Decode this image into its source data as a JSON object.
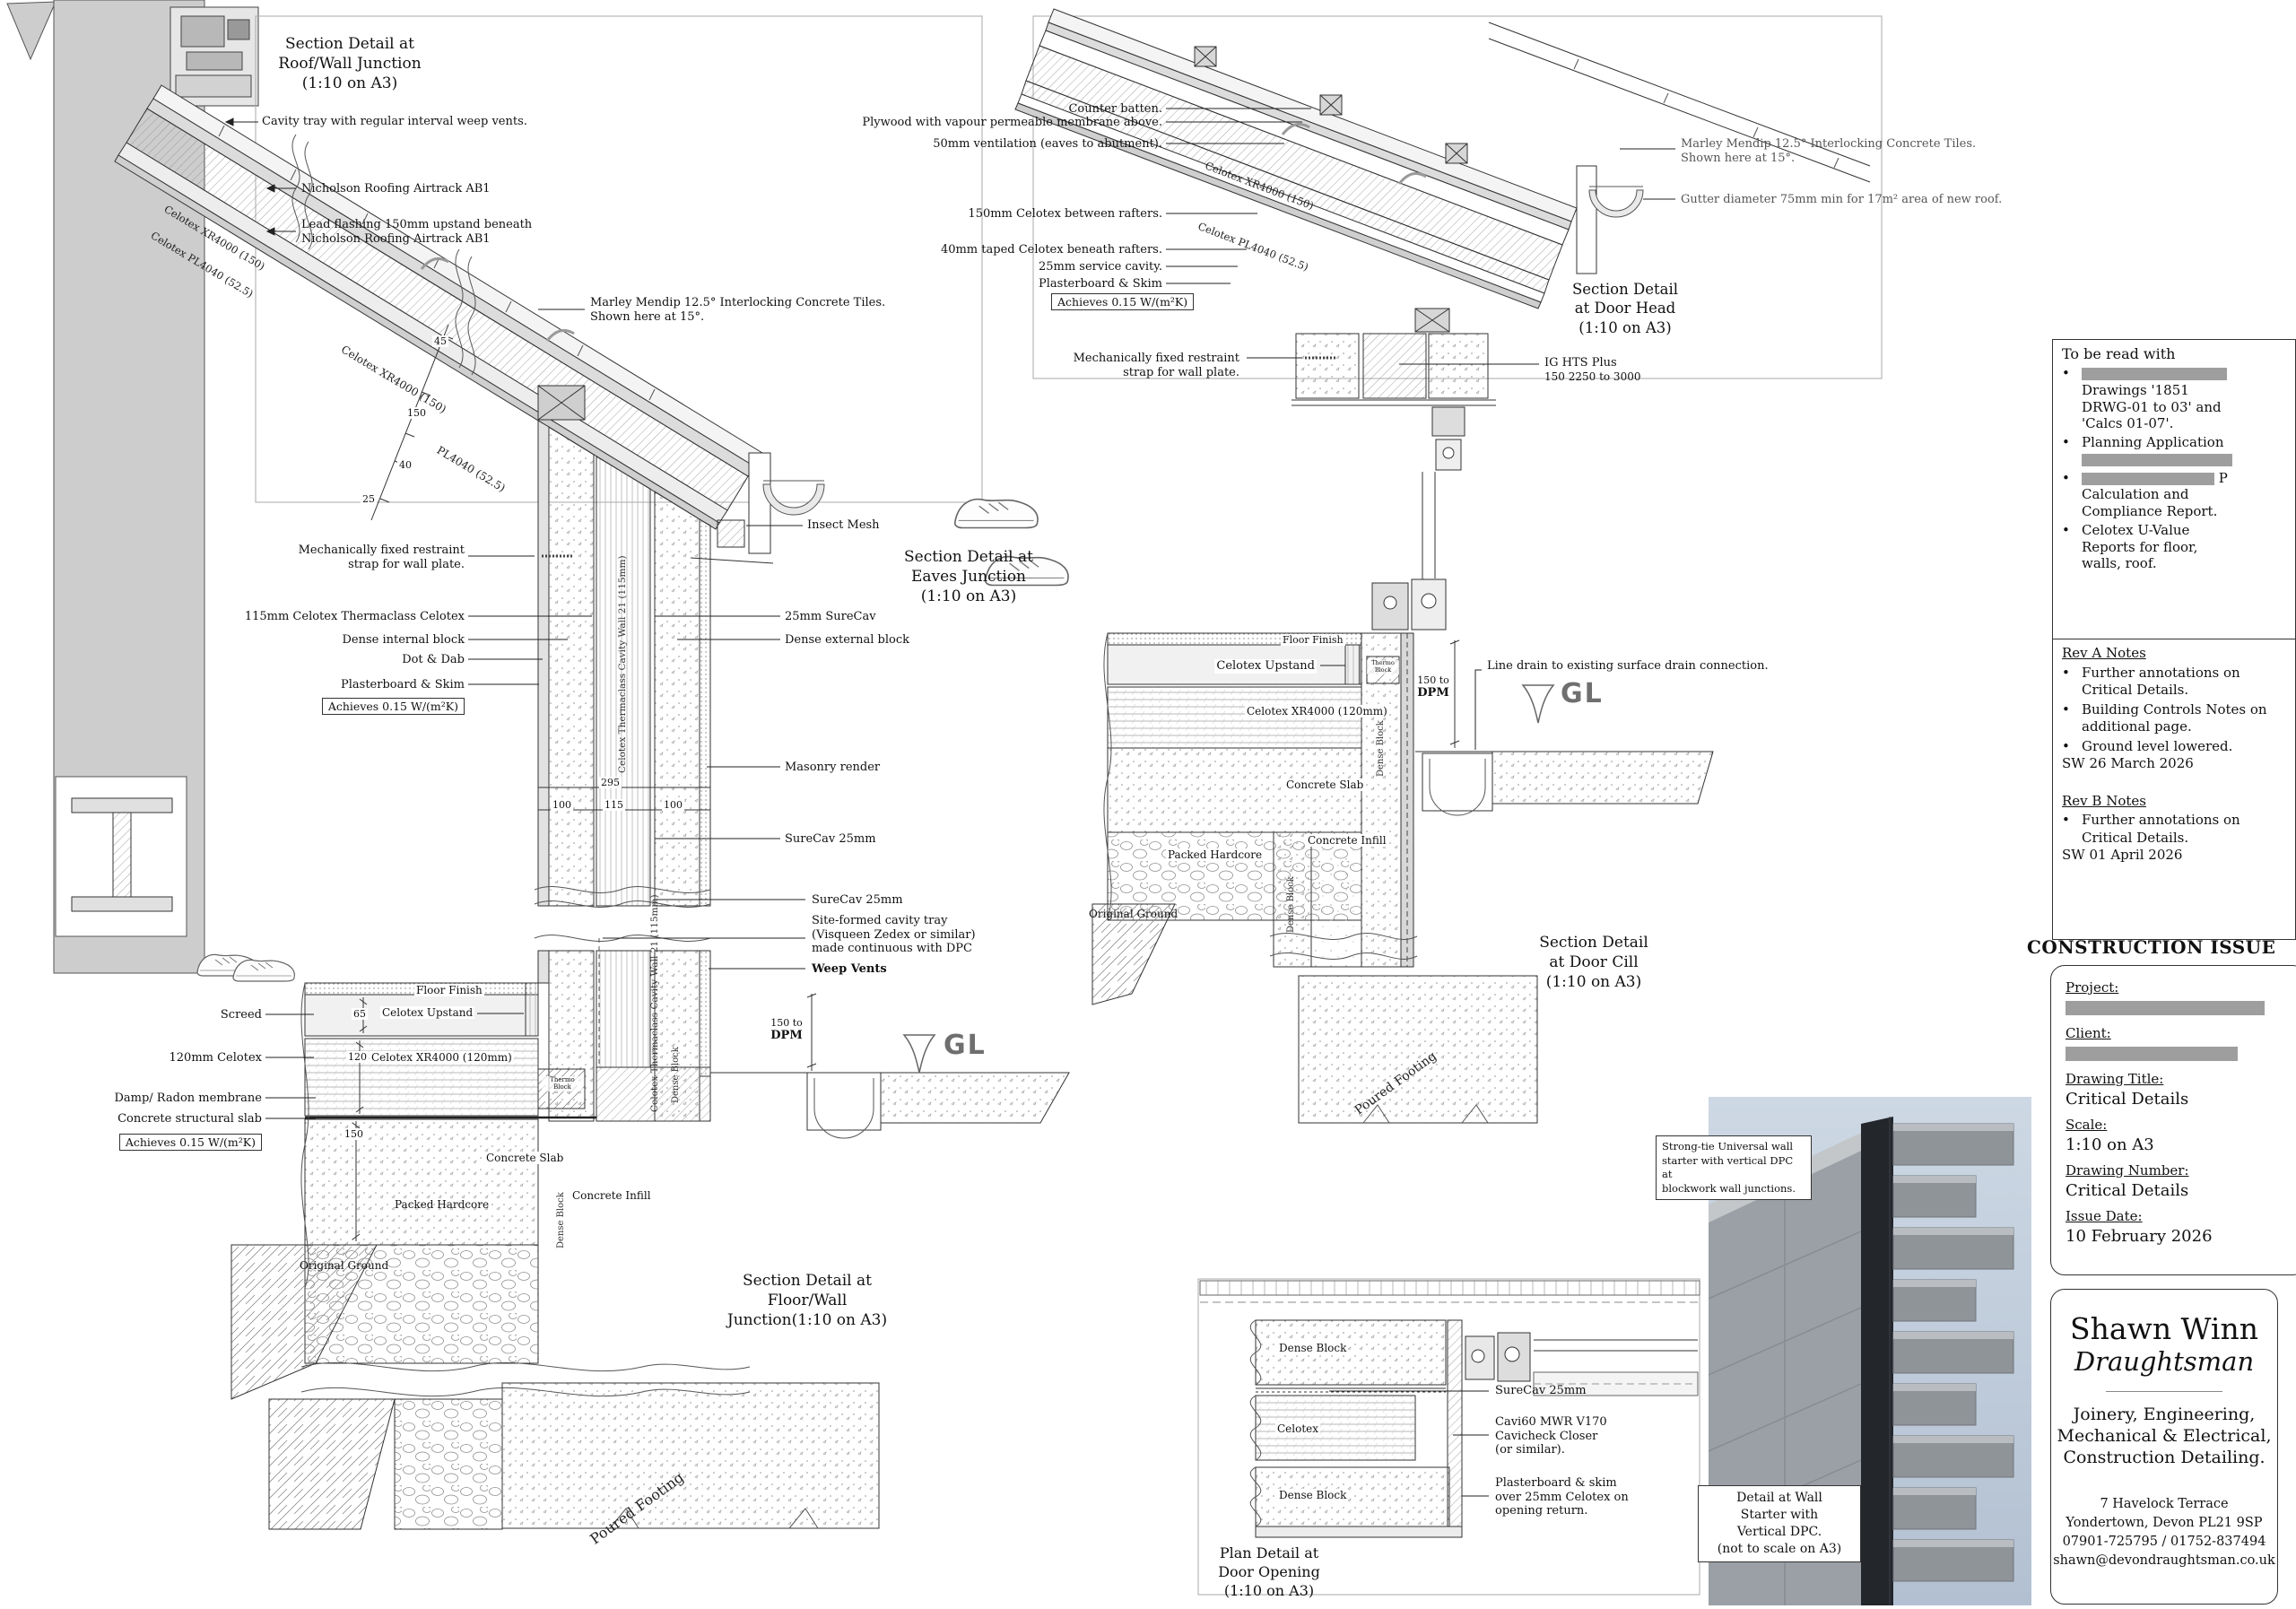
{
  "roof_wall": {
    "title_l1": "Section Detail at",
    "title_l2": "Roof/Wall Junction",
    "title_l3": "(1:10 on A3)",
    "cavity_tray": "Cavity tray with regular interval weep vents.",
    "airtrack": "Nicholson Roofing Airtrack AB1",
    "lead_flashing_l1": "Lead flashing 150mm upstand beneath",
    "lead_flashing_l2": "Nicholson Roofing Airtrack AB1",
    "celotex_xr": "Celotex XR4000 (150)",
    "celotex_pl": "Celotex PL4040 (52.5)"
  },
  "eaves": {
    "title_l1": "Section Detail at",
    "title_l2": "Eaves Junction",
    "title_l3": "(1:10 on A3)",
    "marley_l1": "Marley Mendip 12.5° Interlocking Concrete Tiles.",
    "marley_l2": "Shown here at 15°.",
    "dim_45": "45",
    "dim_150": "150",
    "dim_40": "40",
    "dim_25": "25",
    "dim_total": "295",
    "dim_100a": "100",
    "dim_115": "115",
    "dim_100b": "100",
    "celotex_xr": "Celotex XR4000 (150)",
    "pl4040": "PL4040 (52.5)",
    "restraint_l1": "Mechanically fixed restraint",
    "restraint_l2": "strap for wall plate.",
    "thermaclass": "115mm Celotex Thermaclass Celotex",
    "dense_internal": "Dense internal block",
    "dot_dab": "Dot & Dab",
    "plasterboard": "Plasterboard & Skim",
    "achieves": "Achieves 0.15 W/(m²K)",
    "surecav_right": "25mm SureCav",
    "dense_external": "Dense external block",
    "masonry_render": "Masonry render",
    "surecav_lower": "SureCav 25mm",
    "insect_mesh": "Insect Mesh",
    "cavity_wall_vertical": "Celotex Thermaclass Cavity Wall 21 (115mm)"
  },
  "floor_wall": {
    "title_l1": "Section Detail at",
    "title_l2": "Floor/Wall",
    "title_l3": "Junction(1:10 on A3)",
    "screed": "Screed",
    "celotex_120": "120mm Celotex",
    "damp": "Damp/ Radon membrane",
    "slab": "Concrete structural slab",
    "achieves": "Achieves 0.15 W/(m²K)",
    "floor_finish": "Floor Finish",
    "dim_65": "65",
    "celotex_upstand": "Celotex Upstand",
    "dim_120": "120",
    "xr4000_120": "Celotex XR4000 (120mm)",
    "dim_150": "150",
    "concrete_slab": "Concrete Slab",
    "packed_hardcore": "Packed Hardcore",
    "dense_block": "Dense Block",
    "concrete_infill": "Concrete Infill",
    "original_ground": "Original Ground",
    "poured_footing": "Poured Footing",
    "thermo_l1": "Thermo",
    "thermo_l2": "Block",
    "surecav": "SureCav 25mm",
    "cavity_tray_l1": "Site-formed cavity tray",
    "cavity_tray_l2": "(Visqueen Zedex or similar)",
    "cavity_tray_l3": "made continuous with DPC",
    "weep_vents": "Weep Vents",
    "dpm_l1": "150 to",
    "dpm_l2": "DPM",
    "gl": "GL",
    "cavity_wall_vertical": "Celotex Thermaclass Cavity Wall 21 (115mm)"
  },
  "door_head": {
    "title_l1": "Section Detail",
    "title_l2": "at Door Head",
    "title_l3": "(1:10 on A3)",
    "counter_batten": "Counter batten.",
    "plywood": "Plywood with vapour permeable membrane above.",
    "ventilation": "50mm ventilation (eaves to abutment).",
    "celotex_150": "150mm Celotex between rafters.",
    "celotex_40": "40mm taped Celotex beneath rafters.",
    "service_cavity": "25mm service cavity.",
    "plasterboard": "Plasterboard & Skim",
    "achieves": "Achieves 0.15 W/(m²K)",
    "restraint_l1": "Mechanically fixed restraint",
    "restraint_l2": "strap for wall plate.",
    "ig_l1": "IG HTS Plus",
    "ig_l2": "150 2250 to 3000",
    "marley_l1": "Marley Mendip 12.5° Interlocking Concrete Tiles.",
    "marley_l2": "Shown here at 15°.",
    "gutter": "Gutter diameter 75mm min for 17m² area of new roof.",
    "celotex_xr": "Celotex XR4000 (150)",
    "celotex_pl": "Celotex PL4040 (52.5)"
  },
  "door_cill": {
    "title_l1": "Section Detail",
    "title_l2": "at Door Cill",
    "title_l3": "(1:10 on A3)",
    "floor_finish": "Floor Finish",
    "celotex_upstand": "Celotex Upstand",
    "xr4000_120": "Celotex XR4000 (120mm)",
    "concrete_slab": "Concrete Slab",
    "packed_hardcore": "Packed Hardcore",
    "original_ground": "Original Ground",
    "dense_block_a": "Dense Block",
    "dense_block_b": "Dense Block",
    "concrete_infill": "Concrete Infill",
    "thermo_l1": "Thermo",
    "thermo_l2": "Block",
    "dpm_l1": "150 to",
    "dpm_l2": "DPM",
    "gl": "GL",
    "line_drain": "Line drain to existing surface drain connection.",
    "poured_footing": "Poured Footing"
  },
  "plan_door": {
    "title_l1": "Plan Detail at",
    "title_l2": "Door Opening",
    "title_l3": "(1:10 on A3)",
    "dense_block_a": "Dense Block",
    "celotex": "Celotex",
    "dense_block_b": "Dense Block",
    "surecav": "SureCav 25mm",
    "cavicheck_l1": "Cavi60 MWR V170",
    "cavicheck_l2": "Cavicheck Closer",
    "cavicheck_l3": "(or similar).",
    "plaster_l1": "Plasterboard & skim",
    "plaster_l2": "over 25mm Celotex on",
    "plaster_l3": "opening return."
  },
  "wall_starter": {
    "label_l1": "Strong-tie Universal wall",
    "label_l2": "starter with vertical DPC at",
    "label_l3": "blockwork wall junctions.",
    "caption_l1": "Detail at Wall",
    "caption_l2": "Starter with",
    "caption_l3": "Vertical DPC.",
    "caption_l4": "(not to scale on A3)"
  },
  "read_with": {
    "title": "To be read with",
    "bullet": "•",
    "item1_l1": "Drawings '1851",
    "item1_l2": "DRWG-01 to 03' and",
    "item1_l3": "'Calcs 01-07'.",
    "item2": "Planning Application",
    "item3_suffix": "P",
    "item3_l2": "Calculation and",
    "item3_l3": "Compliance Report.",
    "item4_l1": "Celotex U-Value",
    "item4_l2": "Reports for floor,",
    "item4_l3": "walls, roof."
  },
  "revisions": {
    "bullet": "•",
    "rev_a_title": "Rev A Notes",
    "rev_a_1": "Further annotations on Critical Details.",
    "rev_a_2": "Building Controls Notes on additional page.",
    "rev_a_3": "Ground level lowered.",
    "rev_a_sign": "SW 26 March 2026",
    "rev_b_title": "Rev B Notes",
    "rev_b_1": "Further annotations on Critical Details.",
    "rev_b_sign": "SW 01 April 2026"
  },
  "issue": {
    "heading": "CONSTRUCTION ISSUE",
    "project_label": "Project:",
    "client_label": "Client:",
    "drawing_title_label": "Drawing Title:",
    "drawing_title": "Critical Details",
    "scale_label": "Scale:",
    "scale": "1:10 on A3",
    "drawing_number_label": "Drawing Number:",
    "drawing_number": "Critical Details",
    "issue_date_label": "Issue Date:",
    "issue_date": "10 February 2026"
  },
  "brand": {
    "name": "Shawn Winn",
    "role": "Draughtsman",
    "services_l1": "Joinery, Engineering,",
    "services_l2": "Mechanical & Electrical,",
    "services_l3": "Construction Detailing.",
    "addr_l1": "7 Havelock Terrace",
    "addr_l2": "Yondertown, Devon PL21 9SP",
    "addr_l3": "07901-725795 / 01752-837494",
    "addr_l4": "shawn@devondraughtsman.co.uk"
  }
}
